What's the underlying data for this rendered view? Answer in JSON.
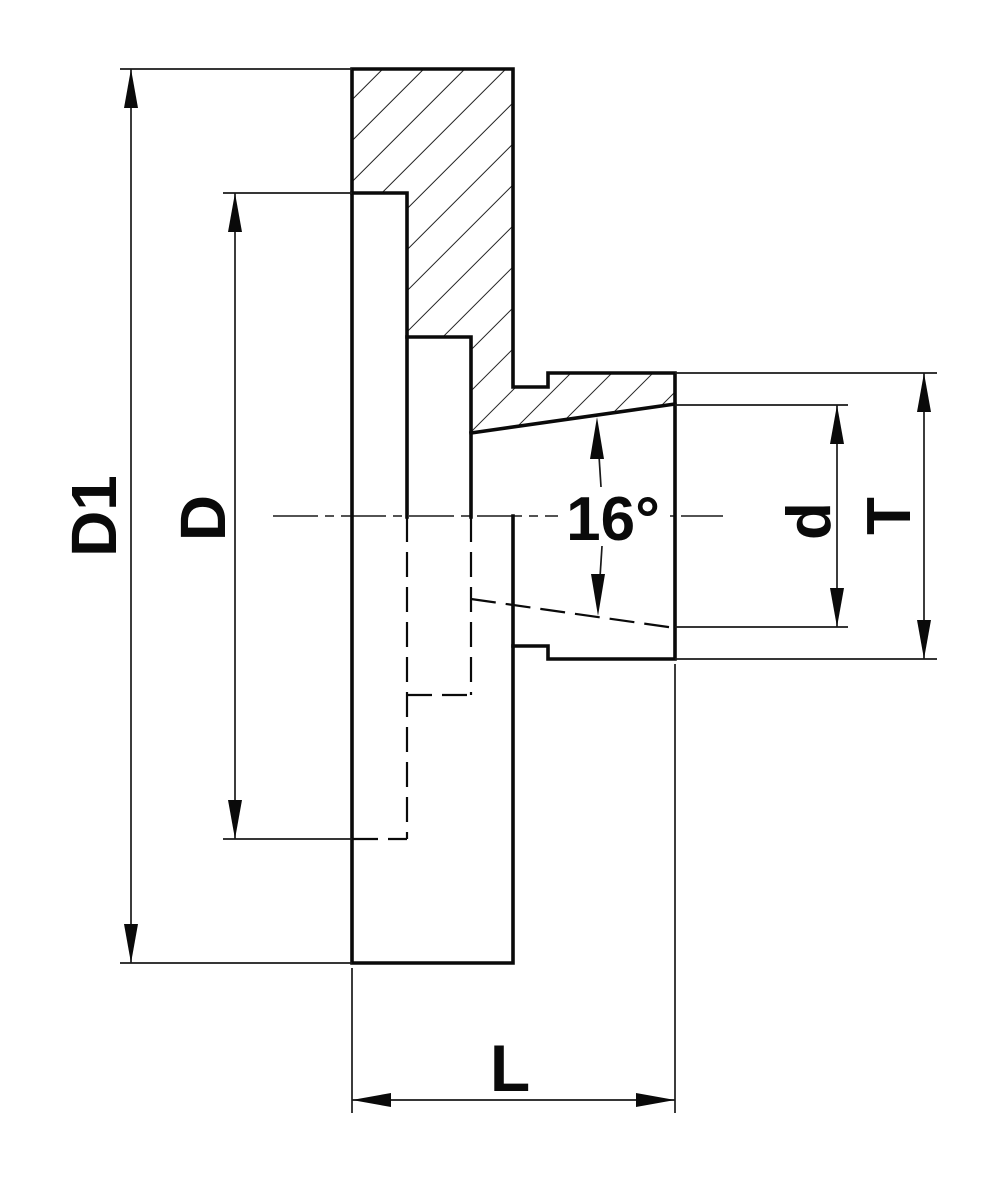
{
  "drawing": {
    "background_color": "#ffffff",
    "line_color": "#0a0a0a",
    "labels": {
      "outer_diameter": "D1",
      "recess_diameter": "D",
      "taper_angle": "16°",
      "small_diameter": "d",
      "big_diameter": "T",
      "length": "L"
    }
  }
}
